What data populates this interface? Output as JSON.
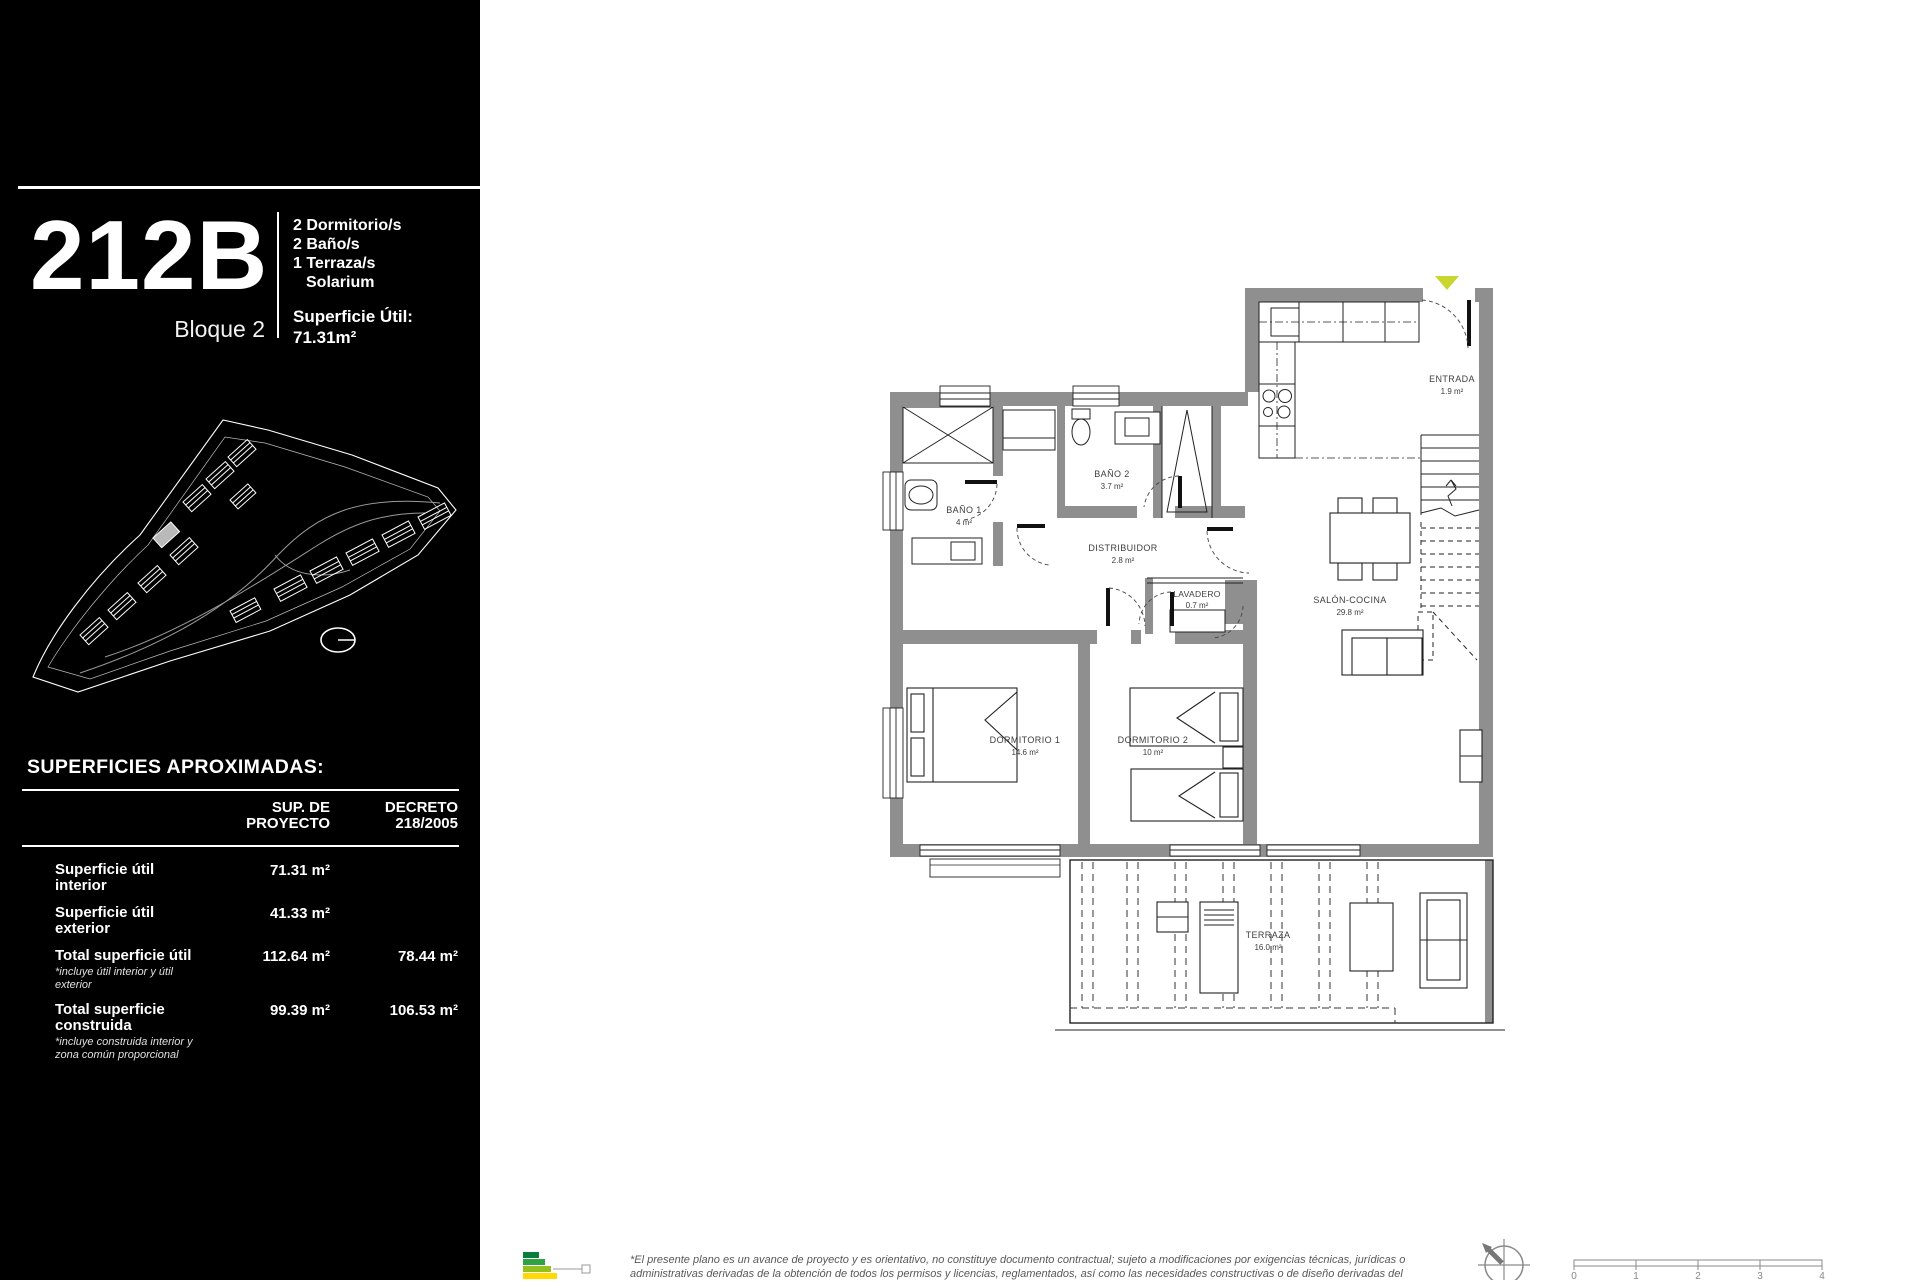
{
  "sidebar": {
    "unit": "212B",
    "block": "Bloque 2",
    "features": [
      "2 Dormitorio/s",
      "2 Baño/s",
      "1 Terraza/s",
      "Solarium"
    ],
    "area_label": "Superficie Útil:",
    "area_value": "71.31m²",
    "surfaces_title": "SUPERFICIES APROXIMADAS:",
    "table": {
      "col1_line1": "SUP. DE",
      "col1_line2": "PROYECTO",
      "col2_line1": "DECRETO",
      "col2_line2": "218/2005",
      "rows": [
        {
          "label": "Superficie útil interior",
          "note": "",
          "proyecto": "71.31 m²",
          "decreto": ""
        },
        {
          "label": "Superficie útil exterior",
          "note": "",
          "proyecto": "41.33 m²",
          "decreto": ""
        },
        {
          "label": "Total superficie útil",
          "note": "*incluye útil interior y útil exterior",
          "proyecto": "112.64 m²",
          "decreto": "78.44 m²"
        },
        {
          "label": "Total superficie construida",
          "note": "*incluye construida interior y zona común proporcional",
          "proyecto": "99.39 m²",
          "decreto": "106.53 m²"
        }
      ]
    }
  },
  "plan": {
    "rooms": [
      {
        "name": "ENTRADA",
        "area": "1.9 m²"
      },
      {
        "name": "BAÑO 1",
        "area": "4 m²"
      },
      {
        "name": "BAÑO 2",
        "area": "3.7 m²"
      },
      {
        "name": "DISTRIBUIDOR",
        "area": "2.8 m²"
      },
      {
        "name": "LAVADERO",
        "area": "0.7 m²"
      },
      {
        "name": "SALÓN-COCINA",
        "area": "29.8 m²"
      },
      {
        "name": "DORMITORIO 1",
        "area": "14.6 m²"
      },
      {
        "name": "DORMITORIO 2",
        "area": "10 m²"
      },
      {
        "name": "TERRAZA",
        "area": "16.0 m²"
      }
    ]
  },
  "footer": {
    "disclaimer_line1": "*El presente plano es un avance de proyecto y es orientativo, no constituye documento contractual; sujeto a modificaciones por exigencias técnicas, jurídicas o",
    "disclaimer_line2": "administrativas derivadas de la obtención de todos los permisos y licencias, reglamentados, así como las necesidades constructivas o de diseño derivadas del",
    "scale_ticks": [
      "0",
      "1",
      "2",
      "3",
      "4"
    ]
  },
  "colors": {
    "wall_gray": "#8f8f8f",
    "marker_yellow": "#c9d62f",
    "energy_dark_green": "#0a7d3c",
    "energy_green": "#2fa340",
    "energy_light_green": "#95c11f",
    "energy_yellow": "#ffd900"
  }
}
